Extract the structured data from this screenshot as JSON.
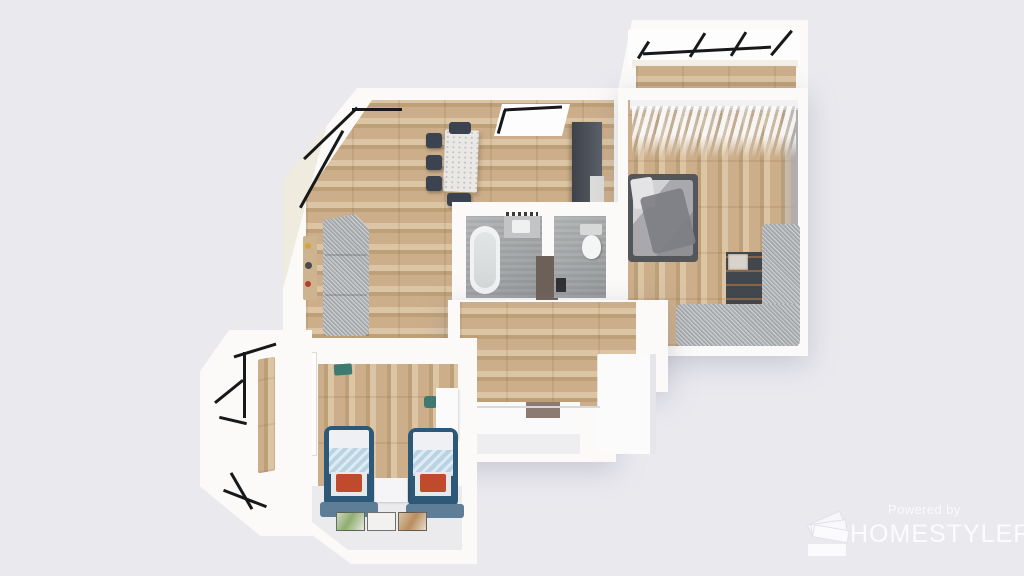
{
  "watermark": {
    "powered_by": "Powered by",
    "brand": "HOMESTYLER"
  },
  "colors": {
    "background": "#e9e9ee",
    "wall": "#fbfaf8",
    "wall_cream": "#f0ebdf",
    "wood": "#ccae8a",
    "wood_light": "#dcc5a4",
    "wood_dark": "#bda077",
    "bath_floor": "#a7aaac",
    "speckle_gray": "#b2b5b8",
    "chair_navy": "#3b4250",
    "marble": "#eae8e4",
    "cabinet_dark": "#42474e",
    "cabinet_brown": "#6d6057",
    "bed_frame_teal": "#2d5877",
    "blanket_blue": "#b9d3e3",
    "pillow_red": "#bf4a2c",
    "mat_blue": "#5d7e96",
    "frame_black": "#17181a",
    "watermark_white": "#fcfcfe"
  },
  "scene": {
    "type": "3d-floorplan-top-view-render",
    "rooms": [
      {
        "name": "balcony-top-right",
        "floor": "wood",
        "features": [
          "black-frame-windows"
        ]
      },
      {
        "name": "living-dining-room",
        "floor": "wood",
        "features": [
          "bay-window",
          "gray-sectional-sofa",
          "marble-dining-table",
          "navy-dining-chairs",
          "wall-shelf-decor"
        ]
      },
      {
        "name": "kitchen",
        "floor": "wood",
        "features": [
          "window",
          "dark-tall-cabinets",
          "counter"
        ]
      },
      {
        "name": "master-bedroom",
        "floor": "wood",
        "features": [
          "open-clothes-rack",
          "double-bed",
          "dark-dresser",
          "l-shaped-gray-sofa"
        ]
      },
      {
        "name": "bathroom",
        "floor": "concrete-gray",
        "features": [
          "bathtub",
          "vanity-sink",
          "brown-cabinet"
        ]
      },
      {
        "name": "toilet-room",
        "floor": "concrete-gray",
        "features": [
          "toilet"
        ]
      },
      {
        "name": "hallway",
        "floor": "wood",
        "features": [
          "white-closet",
          "shoe-bench",
          "doormat"
        ]
      },
      {
        "name": "kids-bedroom",
        "floor": "wood-and-white",
        "features": [
          "window",
          "two-teal-beds",
          "red-pillows",
          "drawer-unit",
          "three-floor-mats",
          "nightstand"
        ]
      },
      {
        "name": "balcony-bottom-left",
        "floor": "wood",
        "features": [
          "angled-bay-black-frame-windows"
        ]
      }
    ]
  }
}
